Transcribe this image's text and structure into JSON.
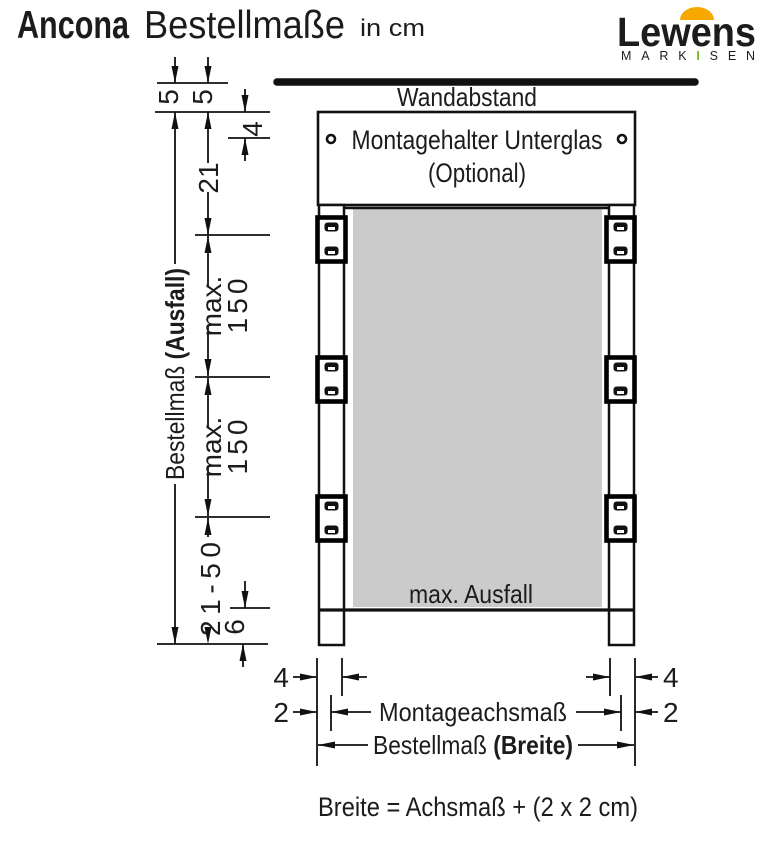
{
  "header": {
    "product": "Ancona",
    "title": "Bestellmaße",
    "unit": "in cm"
  },
  "logo": {
    "brand": "Lewens",
    "tagline_pre": "MARK",
    "tagline_bar": "I",
    "tagline_post": "SEN",
    "green": "#76b82a",
    "orange": "#f6a800",
    "gray": "#9b9b9b"
  },
  "diagram": {
    "wall_label": "Wandabstand",
    "bracket_box": {
      "line1": "Montagehalter Unterglas",
      "line2": "(Optional)"
    },
    "fabric": {
      "label": "max. Ausfall",
      "color": "#cbcbcb"
    },
    "dims": {
      "wall_gap_a": "5",
      "wall_gap_b": "5",
      "underglass_offset": "4",
      "cassette_height": "21",
      "max_drop_upper": {
        "line1": "max.",
        "line2": "150"
      },
      "max_drop_lower": {
        "line1": "max.",
        "line2": "150"
      },
      "bottom_range": "21-50",
      "bottom_profile": "6",
      "ausfall": {
        "normal": "Bestellmaß ",
        "bold": "(Ausfall)"
      },
      "post_width_left": "4",
      "post_width_right": "4",
      "axis_offset_left": "2",
      "axis_offset_right": "2",
      "axis_label": "Montageachsmaß",
      "breite": {
        "normal": "Bestellmaß ",
        "bold": "(Breite)"
      }
    },
    "formula": "Breite = Achsmaß + (2 x 2 cm)"
  }
}
